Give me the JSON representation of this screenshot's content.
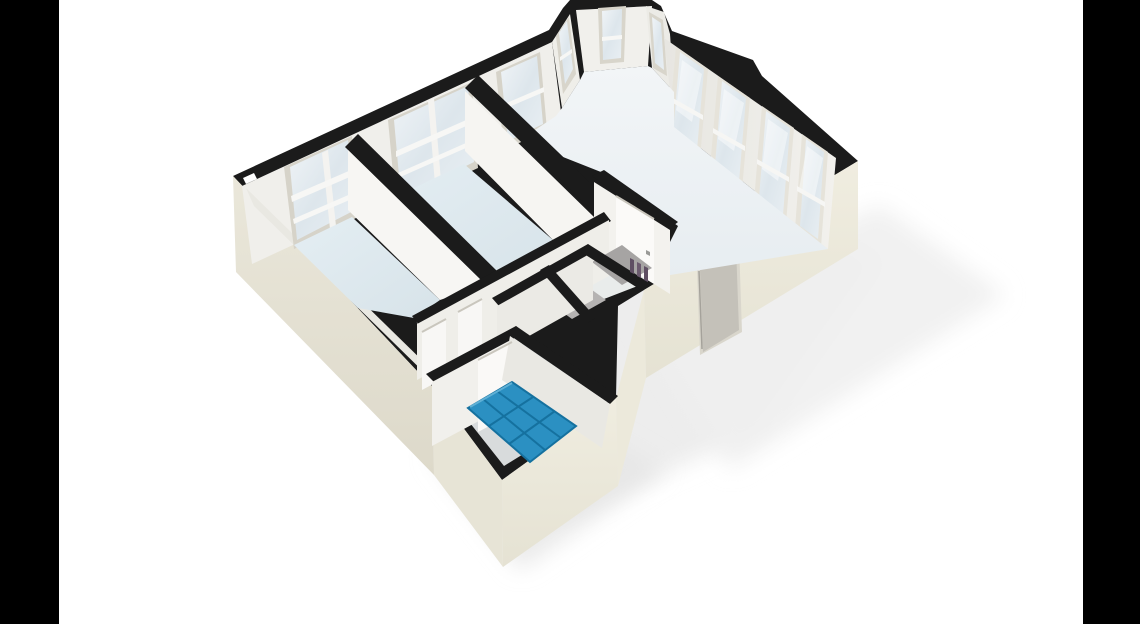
{
  "meta": {
    "title": "3D isometric floor plan rendering of an apartment, letterboxed on white with black side bars",
    "canvas": {
      "w": 1140,
      "h": 624
    },
    "letterbox": {
      "left": "0,0 59,0 59,624 0,624",
      "right": "1083,0 1140,0 1140,624 1083,624",
      "color": "#000000"
    }
  },
  "palette": {
    "wall_top_black": "#1b1b1b",
    "exterior_cream": "#e9e6d9",
    "interior_white": "#f4f3ef",
    "floor_blue": "#dde8ee",
    "living_floor": "#eef2f5",
    "tile_blue": "#2b90c2",
    "tile_grout": "#15719f",
    "glass": "#e3eaef",
    "frame_grey": "#d6d3c9",
    "door_white": "#faf9f7",
    "entry_door_grey": "#c4c1b9",
    "background": "#ffffff"
  },
  "rooms": [
    {
      "name": "bedroom-1",
      "floor": "light-blue"
    },
    {
      "name": "bedroom-2",
      "floor": "light-blue"
    },
    {
      "name": "living-room-with-bay-window",
      "floor": "off-white"
    },
    {
      "name": "hallway",
      "floor": "grey-white"
    },
    {
      "name": "storage-wc-closets",
      "floor": "dark-grey"
    },
    {
      "name": "bathroom",
      "floor": "blue-tiles"
    }
  ],
  "features": [
    "bay-window-three-panes-top",
    "four-tall-windows-north-east-wall",
    "three-windows-north-west-wall",
    "entry-door-south-east-wall",
    "interior-doors-white",
    "blue-tiled-bathroom-floor",
    "soft-ground-shadow"
  ],
  "scene": {
    "shapes": [
      {
        "name": "ground-shadow-main",
        "pts": "300,260 560,520 760,430 880,260 620,150",
        "fill": "#ebebeb",
        "op": 0.9,
        "soft": true
      },
      {
        "name": "ground-shadow-right",
        "pts": "640,320 880,205 1005,295 730,470",
        "fill": "#efefef",
        "op": 0.9,
        "soft": true
      },
      {
        "name": "ground-shadow-bottom",
        "pts": "430,455 520,570 665,470 545,400",
        "fill": "#e6e6e6",
        "op": 0.85,
        "soft": true
      },
      {
        "name": "wall-top-silhouette",
        "pts": "233,176 549,30 563,8 570,0 652,0 661,6 672,31 753,60 762,76 858,161 644,290 618,306 616,398 502,480 433,387 418,372",
        "fill": "#1b1b1b"
      },
      {
        "name": "exterior-face-southwest",
        "pts": "233,176 418,372 433,387 434,475 236,272",
        "fill": "url(#gSW)"
      },
      {
        "name": "exterior-face-bath-west",
        "pts": "433,387 502,480 503,567 434,475",
        "fill": "#e7e4d6"
      },
      {
        "name": "exterior-face-bath-east",
        "pts": "502,480 616,398 618,486 503,567",
        "fill": "url(#gSE)"
      },
      {
        "name": "exterior-face-step",
        "pts": "644,290 616,398 618,486 646,378",
        "fill": "#ece9db"
      },
      {
        "name": "exterior-face-southeast",
        "pts": "858,161 644,290 646,378 858,249",
        "fill": "url(#gSE)"
      },
      {
        "name": "entry-door-frame",
        "pts": "697,268 739,243 742,332 700,355",
        "fill": "#d9d6cc"
      },
      {
        "name": "entry-door",
        "pts": "700,270 736,246 739,330 703,352",
        "fill": "#c4c1b9"
      },
      {
        "name": "interior-face-northwest-wall",
        "pts": "242,186 552,42 562,120 252,264",
        "fill": "#f0efeb"
      },
      {
        "name": "interior-face-southwest-wall",
        "pts": "246,188 432,370 440,388 254,206",
        "fill": "#e9e8e2"
      },
      {
        "name": "window-bedroom1-frame",
        "pts": "284,167 352,136 360,216 294,249",
        "fill": "#d6d3c9"
      },
      {
        "name": "window-bedroom1-glass",
        "pts": "290,167 348,140 355,210 297,240",
        "fill": "url(#gGlass)"
      },
      {
        "name": "window-bedroom1-mullion",
        "pts": "322,153 328,150 336,226 330,229",
        "fill": "#f4f3f0"
      },
      {
        "name": "window-bedroom1-bar1",
        "pts": "291,196 351,170 352,176 292,202",
        "fill": "#f7f7f5"
      },
      {
        "name": "window-bedroom1-bar2",
        "pts": "293,219 353,193 354,198 294,224",
        "fill": "#f7f7f5"
      },
      {
        "name": "window-bedroom2-frame",
        "pts": "388,120 472,82 478,168 396,206",
        "fill": "#d6d3c9"
      },
      {
        "name": "window-bedroom2-glass",
        "pts": "394,120 468,86 474,162 401,198",
        "fill": "url(#gGlass)"
      },
      {
        "name": "window-bedroom2-mullion",
        "pts": "428,101 434,98 441,181 435,184",
        "fill": "#f4f3f0"
      },
      {
        "name": "window-bedroom2-bar1",
        "pts": "396,151 473,117 473,123 396,157",
        "fill": "#f7f7f5"
      },
      {
        "name": "window-bedroom2-bar2",
        "pts": "398,173 475,139 475,144 398,178",
        "fill": "#f7f7f5"
      },
      {
        "name": "window-living-nw-frame",
        "pts": "496,72 540,52 547,130 504,150",
        "fill": "#d6d3c9"
      },
      {
        "name": "window-living-nw-glass",
        "pts": "501,72 537,56 543,124 508,141",
        "fill": "url(#gGlass)"
      },
      {
        "name": "window-living-nw-bar",
        "pts": "502,105 544,87 544,92 502,110",
        "fill": "#f7f7f5"
      },
      {
        "name": "bay-left-wall",
        "pts": "552,42 570,14 580,80 562,108",
        "fill": "#efeee9"
      },
      {
        "name": "bay-window-left-frame",
        "pts": "556,36 569,17 576,74 563,94",
        "fill": "#d8d5cb"
      },
      {
        "name": "bay-window-left-glass",
        "pts": "559,33 567,21 573,69 565,84",
        "fill": "url(#gGlass)"
      },
      {
        "name": "bay-window-left-bar",
        "pts": "560,57 572,49 572,53 560,61",
        "fill": "#f7f7f5"
      },
      {
        "name": "bay-center-wall",
        "pts": "576,10 652,6 648,66 584,72",
        "fill": "#f1f0ec"
      },
      {
        "name": "bay-window-center-frame",
        "pts": "598,8 626,6 624,62 600,64",
        "fill": "#d8d5cb"
      },
      {
        "name": "bay-window-center-glass",
        "pts": "602,11 622,9 621,58 603,60",
        "fill": "url(#gGlass)"
      },
      {
        "name": "bay-window-center-bar",
        "pts": "602,37 622,35 622,39 602,41",
        "fill": "#f7f7f5"
      },
      {
        "name": "bay-right-wall",
        "pts": "646,6 664,12 670,34 674,92 652,68",
        "fill": "#ecebe6"
      },
      {
        "name": "bay-window-right-frame",
        "pts": "649,12 663,20 667,76 653,68",
        "fill": "#d8d5cb"
      },
      {
        "name": "bay-window-right-glass",
        "pts": "652,17 661,23 664,70 655,63",
        "fill": "url(#gGlass)"
      },
      {
        "name": "interior-face-northeast-wall",
        "pts": "664,38 836,158 828,249 674,127",
        "fill": "url(#gNE)"
      },
      {
        "name": "window-ne1-frame",
        "pts": "676,47 708,69 700,158 668,136",
        "fill": "#e6e3da"
      },
      {
        "name": "window-ne1-glass",
        "pts": "680,52 704,69 697,150 673,133",
        "fill": "url(#gGlass)"
      },
      {
        "name": "window-ne1-sheen",
        "pts": "682,60 702,74 692,122 676,110",
        "fill": "#ffffff",
        "op": 0.45
      },
      {
        "name": "window-ne1-bar",
        "pts": "671,97 703,115 703,120 671,102",
        "fill": "#f6f6f4"
      },
      {
        "name": "window-ne2-frame",
        "pts": "718,76 750,98 742,190 710,168",
        "fill": "#e6e3da"
      },
      {
        "name": "window-ne2-glass",
        "pts": "722,81 746,98 739,182 715,165",
        "fill": "url(#gGlass)"
      },
      {
        "name": "window-ne2-sheen",
        "pts": "724,89 744,103 734,151 718,139",
        "fill": "#ffffff",
        "op": 0.45
      },
      {
        "name": "window-ne2-bar",
        "pts": "713,128 745,146 745,151 713,133",
        "fill": "#f6f6f4"
      },
      {
        "name": "window-ne3-frame",
        "pts": "762,106 794,128 786,223 754,201",
        "fill": "#e6e3da"
      },
      {
        "name": "window-ne3-glass",
        "pts": "766,111 790,128 783,215 759,198",
        "fill": "url(#gGlass)"
      },
      {
        "name": "window-ne3-sheen",
        "pts": "768,119 788,133 778,181 762,169",
        "fill": "#ffffff",
        "op": 0.45
      },
      {
        "name": "window-ne3-bar",
        "pts": "757,159 789,177 789,182 757,164",
        "fill": "#f6f6f4"
      },
      {
        "name": "window-ne4-frame",
        "pts": "802,134 828,152 821,247 795,229",
        "fill": "#e6e3da"
      },
      {
        "name": "window-ne4-glass",
        "pts": "806,139 824,152 818,239 800,226",
        "fill": "url(#gGlass)"
      },
      {
        "name": "window-ne4-sheen",
        "pts": "807,146 823,158 814,200 799,189",
        "fill": "#ffffff",
        "op": 0.45
      },
      {
        "name": "window-ne4-bar",
        "pts": "797,186 825,202 825,207 797,191",
        "fill": "#f6f6f4"
      },
      {
        "name": "floor-bedroom1",
        "pts": "294,245 352,217 440,300 414,318 358,308",
        "fill": "url(#gFloor)"
      },
      {
        "name": "floor-bedroom2",
        "pts": "366,211 464,164 553,240 460,291",
        "fill": "url(#gFloor)"
      },
      {
        "name": "floor-living",
        "pts": "520,140 556,116 562,108 580,80 584,72 648,66 652,68 674,92 674,127 828,249 652,278 678,226 606,174",
        "fill": "url(#gLiving)"
      },
      {
        "name": "floor-hallway",
        "pts": "416,320 600,220 648,282 524,330 434,370",
        "fill": "#e9eceb"
      },
      {
        "name": "divider2-wall-top",
        "pts": "465,88 478,75 610,202 597,215",
        "fill": "#1b1b1b"
      },
      {
        "name": "divider2-wall-face",
        "pts": "465,91 595,218 553,240 465,151",
        "fill": "#f6f5f2"
      },
      {
        "name": "divider1-wall-top",
        "pts": "345,147 358,134 498,272 485,284",
        "fill": "#1b1b1b"
      },
      {
        "name": "divider1-wall-face",
        "pts": "348,150 486,285 440,300 348,210",
        "fill": "#f7f6f3"
      },
      {
        "name": "hall-door-wall-top",
        "pts": "592,176 604,170 678,222 668,230",
        "fill": "#1b1b1b"
      },
      {
        "name": "hall-door-wall-face",
        "pts": "594,182 670,230 670,294 594,246",
        "fill": "#f3f2ee"
      },
      {
        "name": "door-hall-living",
        "pts": "616,196 654,219 654,284 616,261",
        "fill": "#fbfaf8"
      },
      {
        "name": "door-hall-living-handle",
        "pts": "646,250 650,252 650,256 646,254",
        "fill": "#9a9a97"
      },
      {
        "name": "hallway-north-wall-top",
        "pts": "412,316 604,212 611,221 419,325",
        "fill": "#1b1b1b"
      },
      {
        "name": "hallway-north-wall-face",
        "pts": "417,324 609,220 609,276 417,380",
        "fill": "#efeee9"
      },
      {
        "name": "door-hall-left",
        "pts": "422,332 446,319 446,377 422,390",
        "fill": "#f8f7f5"
      },
      {
        "name": "door-hall-mid",
        "pts": "458,312 482,299 482,352 458,365",
        "fill": "#f8f7f5"
      },
      {
        "name": "closet-floor-1",
        "pts": "540,296 574,277 606,300 572,319",
        "fill": "#b5b3b2"
      },
      {
        "name": "closet-floor-2",
        "pts": "592,262 622,245 652,268 622,285",
        "fill": "#a6a4a3"
      },
      {
        "name": "closet-wall-top-1",
        "pts": "492,298 588,244 595,252 499,306",
        "fill": "#1b1b1b"
      },
      {
        "name": "closet-wall-face-1",
        "pts": "497,306 593,252 593,300 497,354",
        "fill": "#ebeae5"
      },
      {
        "name": "closet-wall-top-2",
        "pts": "540,270 549,265 596,318 587,323",
        "fill": "#1b1b1b"
      },
      {
        "name": "closet-wall-top-3",
        "pts": "588,244 648,282 641,290 581,252",
        "fill": "#1b1b1b"
      },
      {
        "name": "radiator-mark-1",
        "pts": "630,258 634,260 634,274 630,272",
        "fill": "#5f4f63"
      },
      {
        "name": "radiator-mark-2",
        "pts": "637,262 641,264 641,278 637,276",
        "fill": "#6b5a6e"
      },
      {
        "name": "radiator-mark-3",
        "pts": "644,266 648,268 648,282 644,280",
        "fill": "#5f4f63"
      },
      {
        "name": "bathroom-floor-base",
        "pts": "436,380 522,334 614,398 504,466",
        "fill": "#d8dbdc"
      },
      {
        "name": "bathroom-north-wall-top",
        "pts": "426,374 516,326 524,334 434,382",
        "fill": "#1b1b1b"
      },
      {
        "name": "bathroom-north-wall-face",
        "pts": "432,382 522,334 522,398 432,446",
        "fill": "#f1f0ec"
      },
      {
        "name": "door-bathroom",
        "pts": "478,360 512,342 512,414 478,432",
        "fill": "#faf9f7"
      },
      {
        "name": "door-bathroom-edge",
        "pts": "509,343 513,341 513,414 509,416",
        "fill": "#8d8b86"
      },
      {
        "name": "bathroom-east-wall-top",
        "pts": "516,326 618,396 610,404 508,334",
        "fill": "#1b1b1b"
      },
      {
        "name": "bathroom-east-wall-face",
        "pts": "510,336 610,404 602,448 502,380",
        "fill": "#e9e8e3"
      },
      {
        "name": "bathroom-tiles",
        "pts": "468,408 512,382 576,426 530,462",
        "fill": "#2b90c2",
        "stroke": "#15719f",
        "sw": 2
      },
      {
        "name": "wall-top-notch",
        "pts": "243,178 254,173 257,179 246,184",
        "fill": "#ffffff"
      },
      {
        "name": "letterbox-left",
        "pts": "0,0 59,0 59,624 0,624",
        "fill": "#000000"
      },
      {
        "name": "letterbox-right",
        "pts": "1083,0 1140,0 1140,624 1083,624",
        "fill": "#000000"
      }
    ],
    "lines": [
      {
        "name": "tile-grout-col-1",
        "x1": 483,
        "y1": 399,
        "x2": 545,
        "y2": 450,
        "stroke": "#15719f",
        "w": 2
      },
      {
        "name": "tile-grout-col-2",
        "x1": 497,
        "y1": 391,
        "x2": 561,
        "y2": 438,
        "stroke": "#15719f",
        "w": 2
      },
      {
        "name": "tile-grout-row-1",
        "x1": 489,
        "y1": 426,
        "x2": 533,
        "y2": 397,
        "stroke": "#15719f",
        "w": 2
      },
      {
        "name": "tile-grout-row-2",
        "x1": 509,
        "y1": 444,
        "x2": 555,
        "y2": 411,
        "stroke": "#15719f",
        "w": 2
      },
      {
        "name": "tile-highlight",
        "x1": 470,
        "y1": 407,
        "x2": 512,
        "y2": 383,
        "stroke": "#5fb0d5",
        "w": 2
      },
      {
        "name": "entry-door-seam",
        "x1": 702,
        "y1": 349,
        "x2": 699,
        "y2": 271,
        "stroke": "#a5a29b",
        "w": 1.5
      },
      {
        "name": "door-hall-left-frame",
        "x1": 422,
        "y1": 332,
        "x2": 446,
        "y2": 319,
        "stroke": "#c9c6bd",
        "w": 2
      },
      {
        "name": "door-hall-mid-frame",
        "x1": 458,
        "y1": 312,
        "x2": 482,
        "y2": 299,
        "stroke": "#c9c6bd",
        "w": 2
      },
      {
        "name": "door-hall-living-frame",
        "x1": 616,
        "y1": 196,
        "x2": 654,
        "y2": 219,
        "stroke": "#c9c6bd",
        "w": 2
      },
      {
        "name": "door-bathroom-frame",
        "x1": 478,
        "y1": 360,
        "x2": 512,
        "y2": 342,
        "stroke": "#c9c6bd",
        "w": 2
      }
    ]
  }
}
